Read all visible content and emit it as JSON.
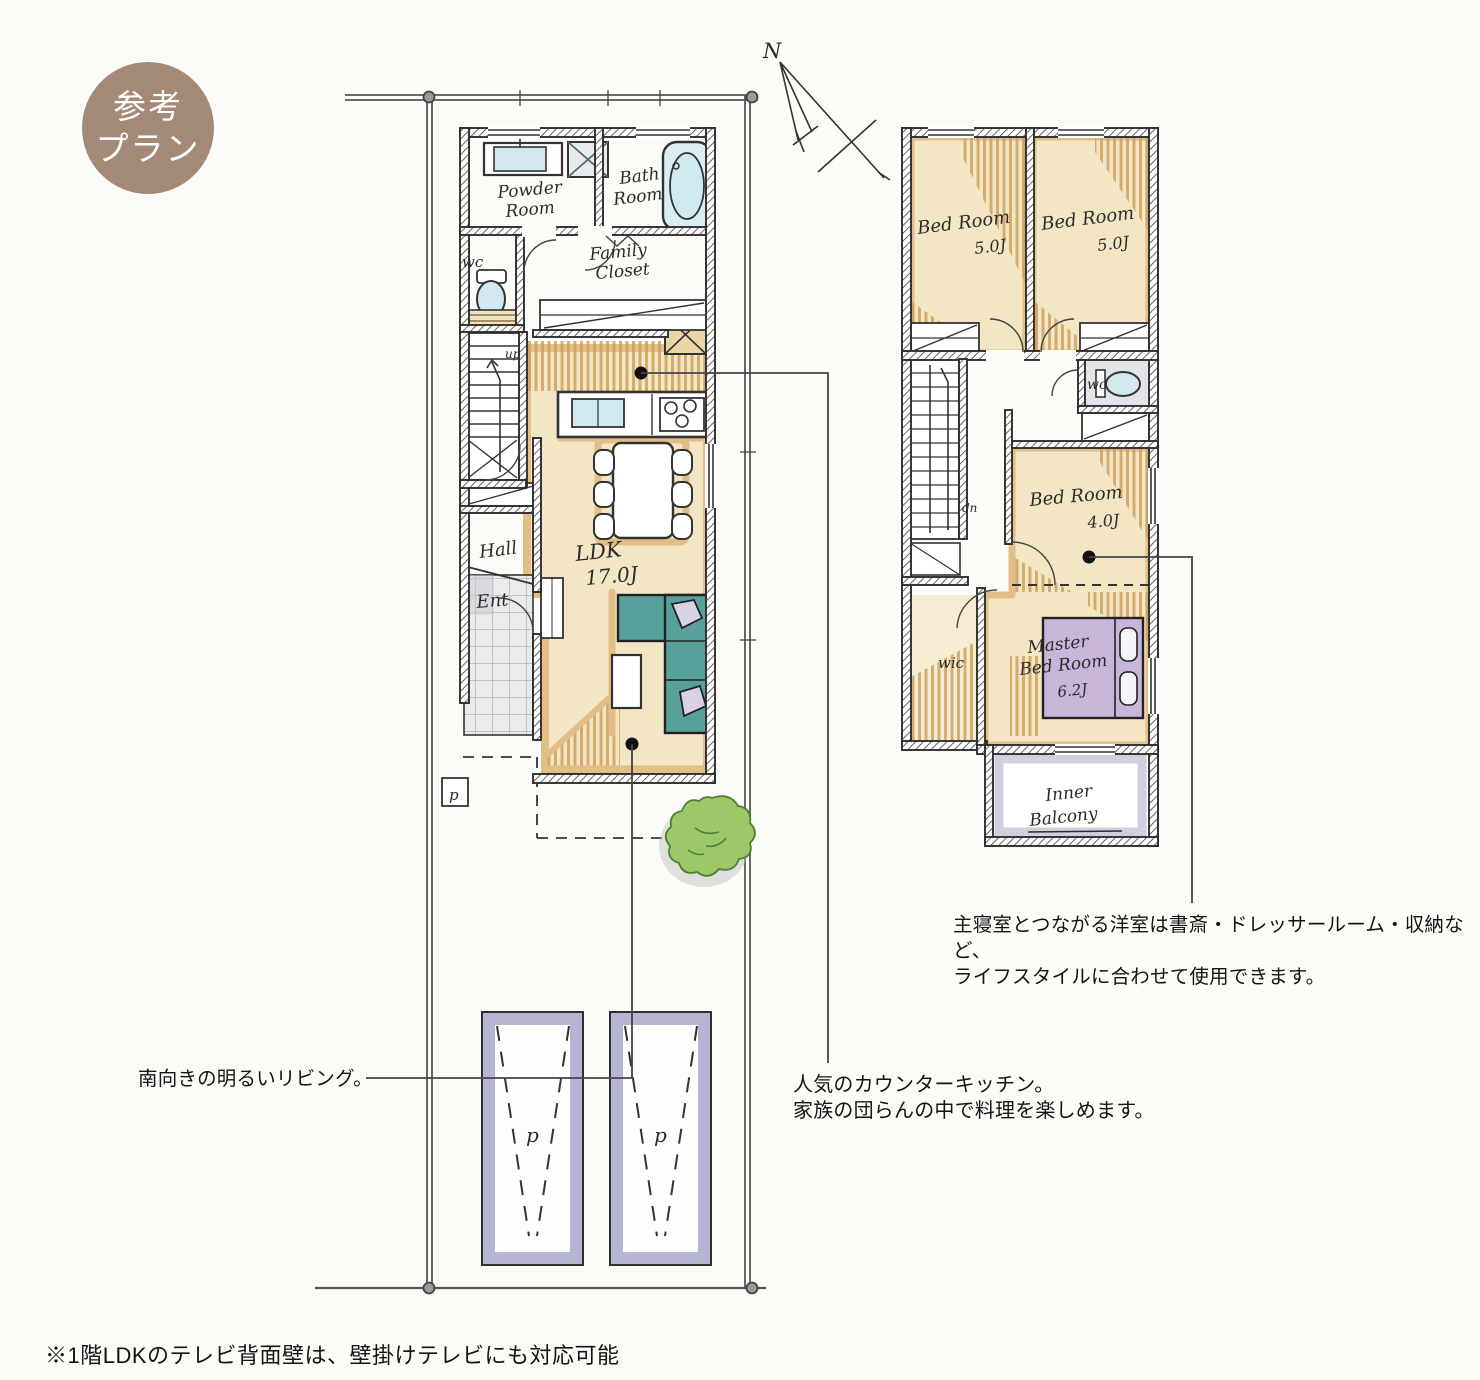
{
  "badge": {
    "line1": "参考",
    "line2": "プラン"
  },
  "north_label": "N",
  "floor1": {
    "powder_line1": "Powder",
    "powder_line2": "Room",
    "bath_line1": "Bath",
    "bath_line2": "Room",
    "wc": "wc",
    "family_line1": "Family",
    "family_line2": "Closet",
    "up": "up",
    "hall": "Hall",
    "ent": "Ent",
    "ldk": "LDK",
    "ldk_size": "17.0J",
    "pole": "p"
  },
  "floor2": {
    "bed1_label": "Bed Room",
    "bed1_size": "5.0J",
    "bed2_label": "Bed Room",
    "bed2_size": "5.0J",
    "bed3_label": "Bed Room",
    "bed3_size": "4.0J",
    "wc": "wc",
    "dn": "dn",
    "wic": "wic",
    "master_line1": "Master",
    "master_line2": "Bed Room",
    "master_size": "6.2J",
    "balcony_line1": "Inner",
    "balcony_line2": "Balcony"
  },
  "parking": {
    "label": "p"
  },
  "annotations": {
    "living": "南向きの明るいリビング。",
    "kitchen_line1": "人気のカウンターキッチン。",
    "kitchen_line2": "家族の団らんの中で料理を楽しめます。",
    "bedroom_line1": "主寝室とつながる洋室は書斎・ドレッサールーム・収納など、",
    "bedroom_line2": "ライフスタイルに合わせて使用できます。"
  },
  "footnote": "※1階LDKのテレビ背面壁は、壁掛けテレビにも対応可能",
  "colors": {
    "badge": "#a48a76",
    "floor": "#f3e6c4",
    "floor_accent": "#e3bf87",
    "wood_line": "#cf9e58",
    "sofa": "#57a19a",
    "bed": "#c7b6da",
    "parking": "#aeadcf",
    "water": "#cfe9ef",
    "tree": "#9cc968",
    "wall": "#2e2e2e"
  }
}
